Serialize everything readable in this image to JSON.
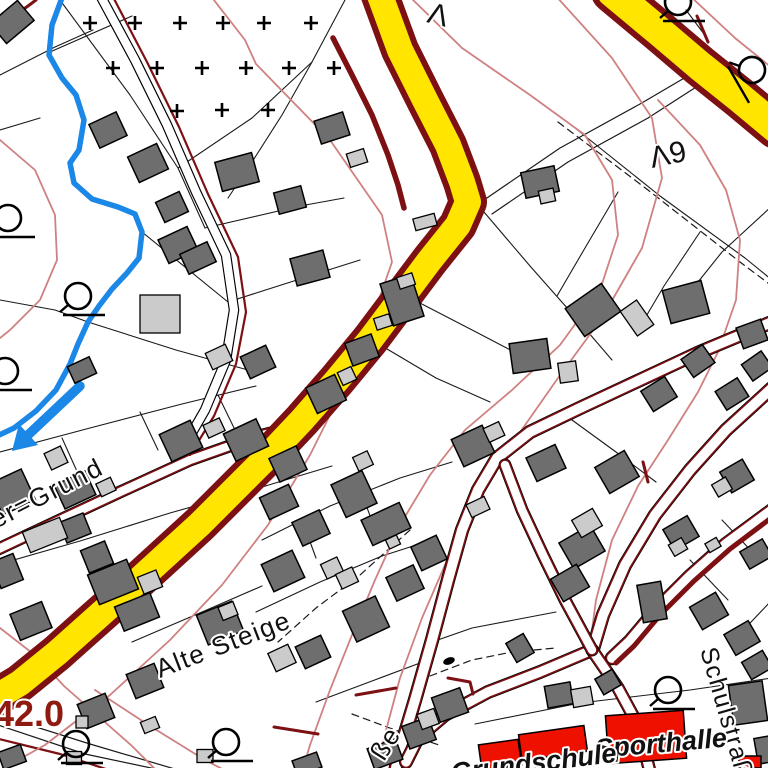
{
  "map": {
    "type": "cadastral-topographic-map",
    "labels": [
      {
        "id": "street-ther-grund",
        "text": "ther=Grund",
        "x": -26,
        "y": 540,
        "rot": -27,
        "size": 26,
        "style": "street"
      },
      {
        "id": "street-alte-steige",
        "text": "Alte Steige",
        "x": 160,
        "y": 678,
        "rot": -21,
        "size": 26,
        "style": "street"
      },
      {
        "id": "street-sse",
        "text": "ße",
        "x": 384,
        "y": 762,
        "rot": -58,
        "size": 26,
        "style": "street"
      },
      {
        "id": "street-schulstrasse",
        "text": "Schulstraße",
        "x": 700,
        "y": 650,
        "rot": 74,
        "size": 25,
        "style": "street"
      },
      {
        "id": "contour-elevation",
        "text": "42.0",
        "x": -6,
        "y": 726,
        "rot": 0,
        "size": 36,
        "style": "contour"
      },
      {
        "id": "poi-sporthalle",
        "text": "Sporthalle",
        "x": 596,
        "y": 758,
        "rot": -5,
        "size": 27,
        "style": "poi"
      },
      {
        "id": "poi-grundschule",
        "text": "Grundschule",
        "x": 452,
        "y": 782,
        "rot": -7,
        "size": 27,
        "style": "poi"
      },
      {
        "id": "marker-lambda9",
        "text": "Λ9",
        "x": 652,
        "y": 168,
        "rot": -12,
        "size": 30,
        "style": "plain"
      },
      {
        "id": "marker-top-partial",
        "text": "Λ",
        "x": 426,
        "y": 22,
        "rot": 14,
        "size": 30,
        "style": "plain"
      }
    ],
    "colors": {
      "road_fill": "#ffe500",
      "road_casing": "#7d1012",
      "wall": "#7d1012",
      "contour_line": "#cf8181",
      "stream": "#1b87e6",
      "building": "#6e6e6e",
      "building_light": "#cbcbcb",
      "building_red": "#ee1100",
      "outline": "#000000",
      "parcel_line": "#1a1a1a",
      "contour_label": "#8e1a10",
      "label_text": "#111111",
      "background": "#ffffff"
    },
    "symbols": [
      {
        "name": "forest-plus-marker",
        "count": 15
      },
      {
        "name": "survey-circle-marker",
        "count": 8
      },
      {
        "name": "stream-flow-arrow-icon",
        "count": 1
      },
      {
        "name": "point-marker-dot",
        "count": 1
      }
    ]
  }
}
